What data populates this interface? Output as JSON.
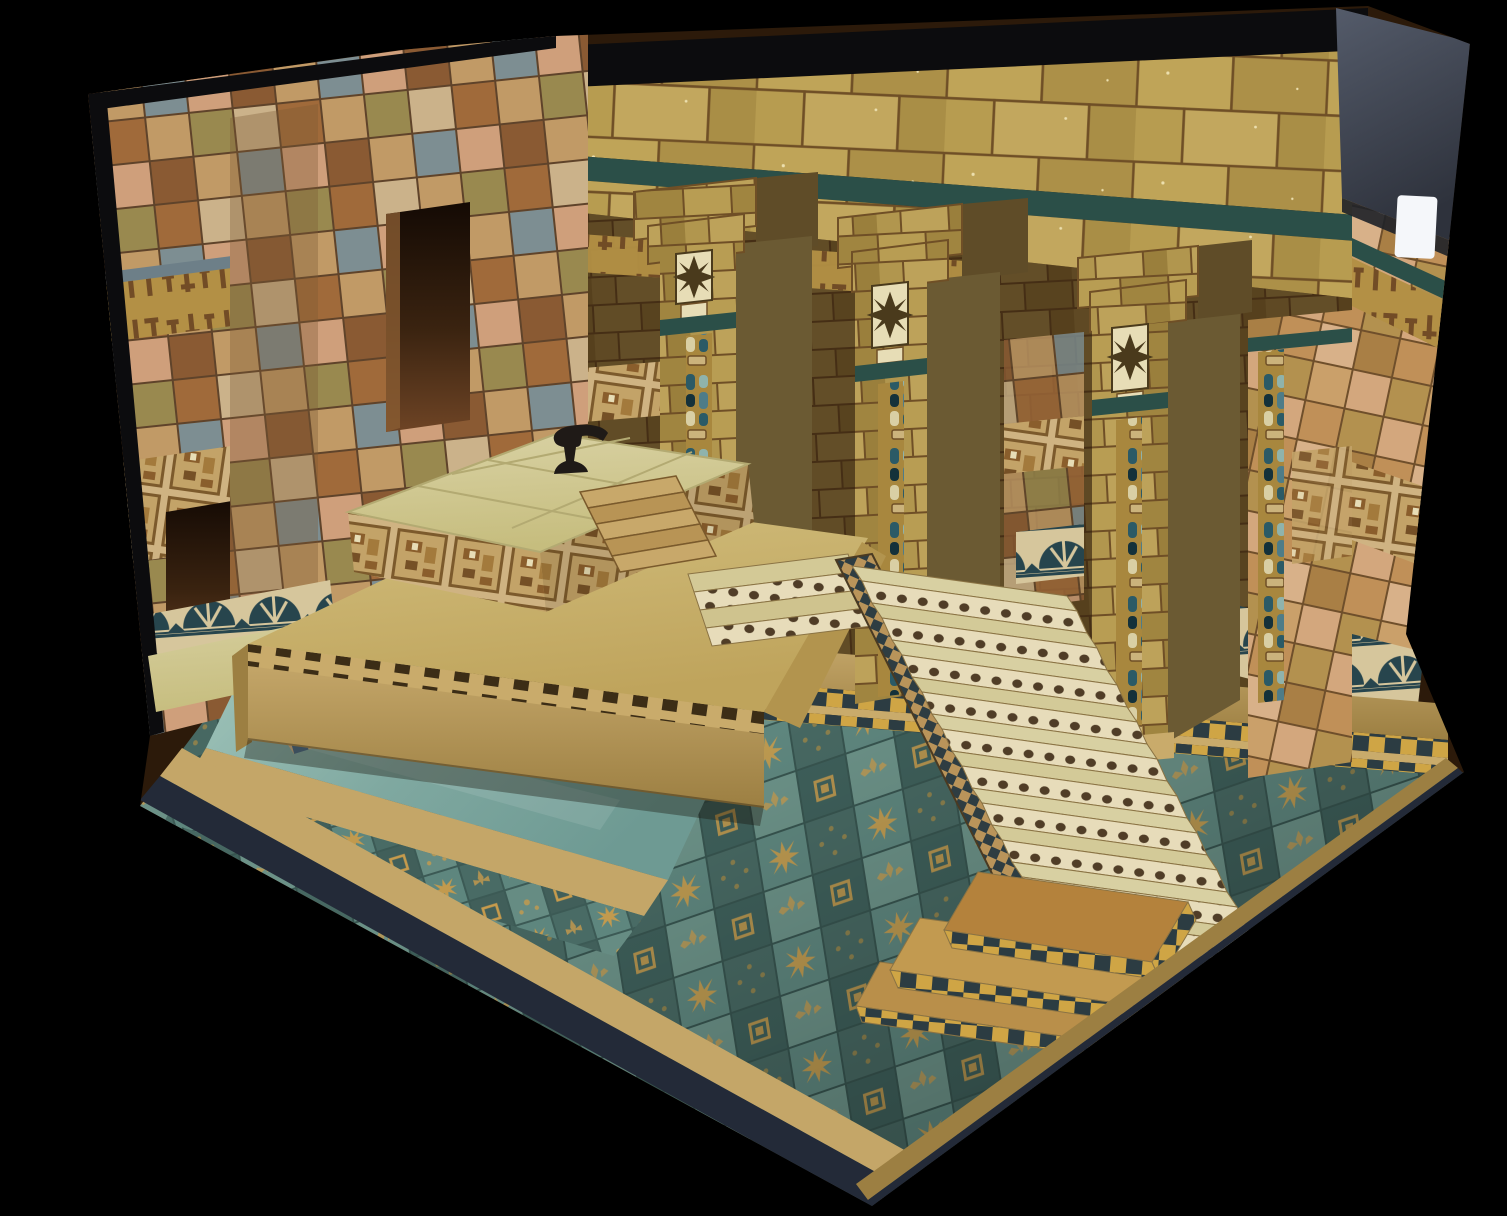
{
  "scene": {
    "title": "Photograph of a hand-painted scale model of a Babylonian temple courtyard: glazed-brick walls, rosette pillars, an altar platform with a small black anvil-shaped offering stand, a grand tiled staircase, checkered steps, a reflecting pool and an ornamented teal-tile courtyard floor, shot against a black backdrop",
    "medium": "photograph of a physical architectural diorama",
    "elements": [
      {
        "name": "left-wall",
        "label": "Variegated glazed-brick wall with cuneiform frieze, relief frieze, palmette border and doorway"
      },
      {
        "name": "tower-face",
        "label": "Corner tower with tall dark niche"
      },
      {
        "name": "back-wall",
        "label": "Portico entablature of golden bricks with dark top trim and teal cornice"
      },
      {
        "name": "pillar",
        "label": "Square pillar with eight-point rosette panel, inscription cartouche, teal band and blue mosaic inlay strip"
      },
      {
        "name": "inner-hall",
        "label": "Shadowed inner hall with cuneiform, relief and palmette friezes"
      },
      {
        "name": "right-wall",
        "label": "Right return wall with cuneiform band, relief frieze and palmette border"
      },
      {
        "name": "box-side-panel",
        "label": "Dark display-box side panel with white label sticker"
      },
      {
        "name": "terrace",
        "label": "Raised altar terrace with dentil band"
      },
      {
        "name": "altar-dais",
        "label": "Altar dais with relief-paneled sides, small wooden steps and black anvil"
      },
      {
        "name": "grand-staircase",
        "label": "Long staircase with dotted risers and checkered stringer"
      },
      {
        "name": "stair-landing",
        "label": "Stacked landing slabs with yellow-and-black checkered edges"
      },
      {
        "name": "portico-steps",
        "label": "Two checkered steps along the portico edge"
      },
      {
        "name": "reflecting-pool",
        "label": "Teal water channel with tan curbs and patterned walkway"
      },
      {
        "name": "courtyard-floor",
        "label": "Teal tiles with gold star, cross and knot ornaments"
      },
      {
        "name": "door-steps",
        "label": "Small steps with blue checkered risers before the side doorway"
      },
      {
        "name": "model-base",
        "label": "Tan base rim over dark navy base board"
      }
    ]
  },
  "palette": {
    "bg": "#000000",
    "trim_black": "#0c0c0e",
    "base_edge": "#232a38",
    "box_panel": "#4b5160",
    "label_white": "#f5f7fa",
    "gold_light": "#c2a75e",
    "gold_mid": "#b49a52",
    "gold_dark": "#a98e46",
    "mortar_brown": "#6f4f26",
    "brick_pink": "#cf9f7b",
    "tile_slate": "#6d7f88",
    "teal_stripe": "#2b4f48",
    "cream_panel": "#e7ddb6",
    "relief_brown": "#7c5a2c",
    "rosette_dark": "#4a3a1c",
    "mosaic_gold": "#a8873e",
    "mosaic_teal": "#2b5a66",
    "water_teal": "#7fa8a0",
    "floor_teal": "#5e867e",
    "floor_teal_dark": "#3e5f5a",
    "floor_gold": "#c79b4c",
    "checker_yellow": "#cfa545",
    "checker_dark": "#2c3c42",
    "stone_tan": "#c9ab6b",
    "stone_tan_dark": "#9c7f42",
    "platform_pale": "#d6cf8d",
    "opening_dark": "#2c1a0a",
    "anvil_black": "#1f1a17",
    "cune_ground": "#b39045",
    "pool_curb": "#c4a668"
  }
}
